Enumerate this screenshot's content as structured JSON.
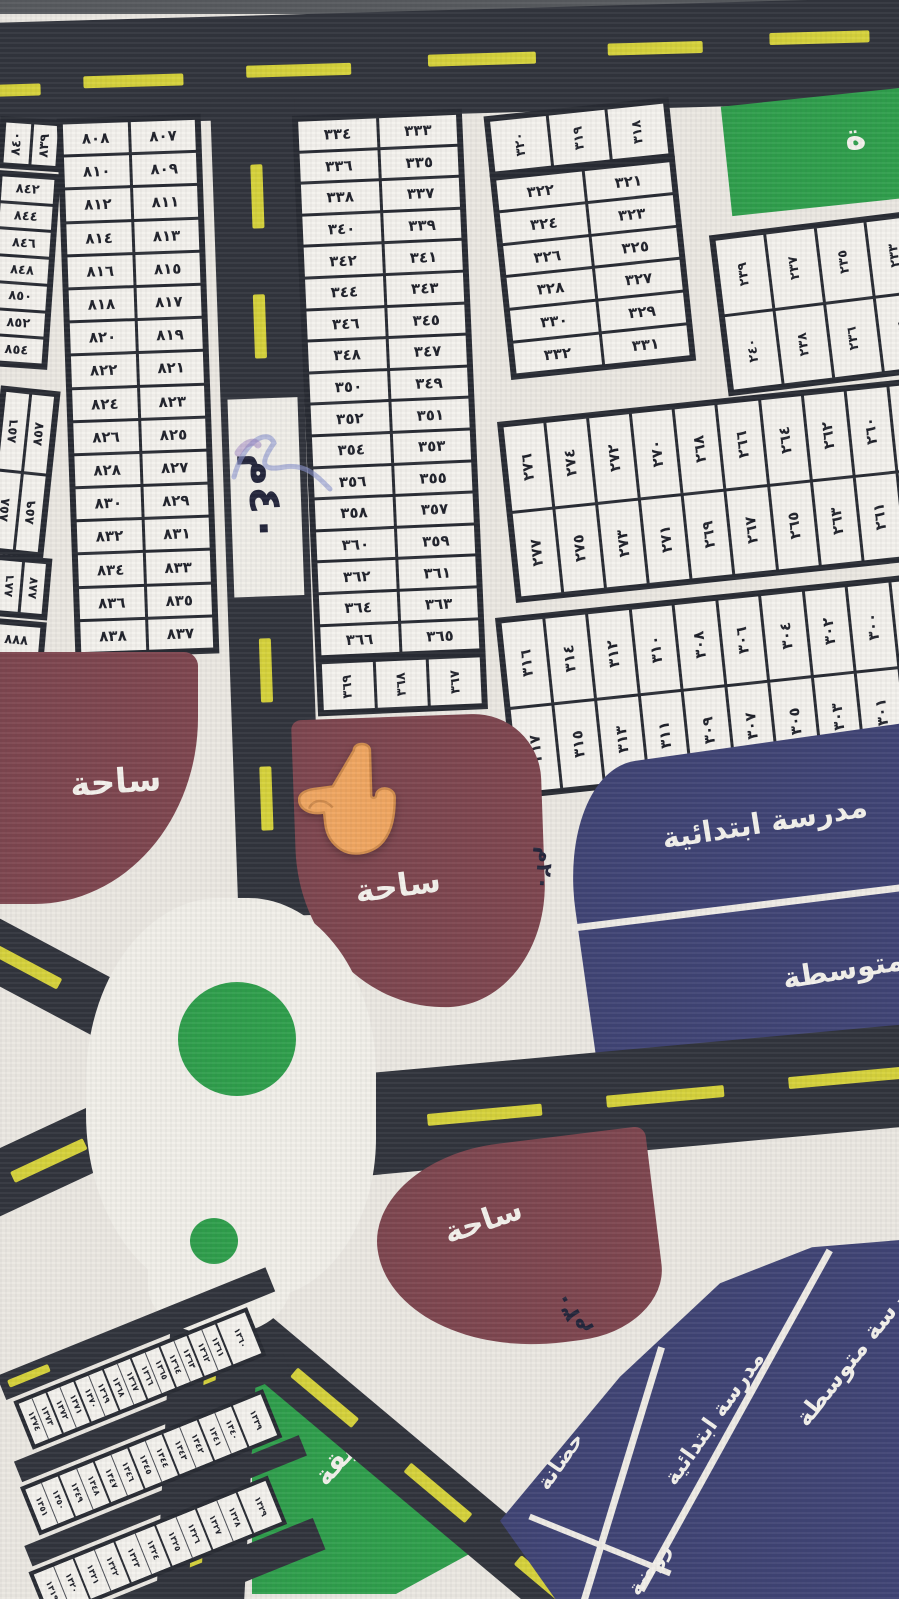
{
  "labels": {
    "plaza": "ساحة",
    "garden": "حديقة",
    "garden_partial": "ة",
    "elementary_school": "مدرسة ابتدائية",
    "middle_school_partial": "ة متوسطة",
    "middle_school": "مدرسة متوسطة",
    "nursery": "حضانة",
    "kindergarten": "روضة",
    "street_sign": "٤٠م",
    "width_marker_20": "٢٠م",
    "width_marker_30": "٣٠م"
  },
  "icons": {
    "pointer": "pointing-up-finger",
    "scribble": "pen-scribble"
  },
  "colors": {
    "road": "#30333b",
    "dash": "#d6d23a",
    "maroon": "#7d454e",
    "navy": "#3f4374",
    "green": "#2e9e4b",
    "paper": "#ebe8e2",
    "cell": "#f4f2ed",
    "ink": "#1e2029"
  },
  "blocks": {
    "west_header": [
      "٨٤٠",
      "٨٣٩"
    ],
    "west_col": [
      "٨٤٢",
      "٨٤٤",
      "٨٤٦",
      "٨٤٨",
      "٨٥٠",
      "٨٥٢",
      "٨٥٤"
    ],
    "west_rows": [
      [
        "٨٠٨",
        "٨٠٧"
      ],
      [
        "٨١٠",
        "٨٠٩"
      ],
      [
        "٨١٢",
        "٨١١"
      ],
      [
        "٨١٤",
        "٨١٣"
      ],
      [
        "٨١٦",
        "٨١٥"
      ],
      [
        "٨١٨",
        "٨١٧"
      ],
      [
        "٨٢٠",
        "٨١٩"
      ],
      [
        "٨٢٢",
        "٨٢١"
      ],
      [
        "٨٢٤",
        "٨٢٣"
      ],
      [
        "٨٢٦",
        "٨٢٥"
      ],
      [
        "٨٢٨",
        "٨٢٧"
      ],
      [
        "٨٣٠",
        "٨٢٩"
      ],
      [
        "٨٣٢",
        "٨٣١"
      ],
      [
        "٨٣٤",
        "٨٣٣"
      ],
      [
        "٨٣٦",
        "٨٣٥"
      ],
      [
        "٨٣٨",
        "٨٣٧"
      ]
    ],
    "west_quad": [
      "٨٥٦",
      "٨٥٧",
      "٨٥٨",
      "٨٥٩"
    ],
    "west_pair": [
      "٨٨٦",
      "٨٨٧"
    ],
    "west_single": "٨٨٨",
    "center_rows": [
      [
        "٣٣٤",
        "٣٣٣"
      ],
      [
        "٣٣٦",
        "٣٣٥"
      ],
      [
        "٣٣٨",
        "٣٣٧"
      ],
      [
        "٣٤٠",
        "٣٣٩"
      ],
      [
        "٣٤٢",
        "٣٤١"
      ],
      [
        "٣٤٤",
        "٣٤٣"
      ],
      [
        "٣٤٦",
        "٣٤٥"
      ],
      [
        "٣٤٨",
        "٣٤٧"
      ],
      [
        "٣٥٠",
        "٣٤٩"
      ],
      [
        "٣٥٢",
        "٣٥١"
      ],
      [
        "٣٥٤",
        "٣٥٣"
      ],
      [
        "٣٥٦",
        "٣٥٥"
      ],
      [
        "٣٥٨",
        "٣٥٧"
      ],
      [
        "٣٦٠",
        "٣٥٩"
      ],
      [
        "٣٦٢",
        "٣٦١"
      ],
      [
        "٣٦٤",
        "٣٦٣"
      ],
      [
        "٣٦٦",
        "٣٦٥"
      ]
    ],
    "center_bottom": [
      "٣٦٩",
      "٣٦٨",
      "٣٦٧"
    ],
    "ne_header": [
      "٣٢٠",
      "٣١٩",
      "٣١٨"
    ],
    "ne_rows": [
      [
        "٣٢٢",
        "٣٢١"
      ],
      [
        "٣٢٤",
        "٣٢٣"
      ],
      [
        "٣٢٦",
        "٣٢٥"
      ],
      [
        "٣٢٨",
        "٣٢٧"
      ],
      [
        "٣٣٠",
        "٣٢٩"
      ],
      [
        "٣٣٢",
        "٣٣١"
      ]
    ],
    "far_ne_top": [
      "٢٣٩",
      "٢٣٧",
      "٢٣٥",
      "٢٣٣"
    ],
    "far_ne_bottom": [
      "٢٤٠",
      "٢٣٨",
      "٢٣٦",
      "٢٣٤"
    ],
    "east1_top": [
      "٢٧٦",
      "٢٧٤",
      "٢٧٢",
      "٢٧٠",
      "٢٦٨",
      "٢٦٦",
      "٢٦٤",
      "٢٦٢",
      "٢٦٠",
      "٢٥٨"
    ],
    "east1_bottom": [
      "٢٧٧",
      "٢٧٥",
      "٢٧٣",
      "٢٧١",
      "٢٦٩",
      "٢٦٧",
      "٢٦٥",
      "٢٦٣",
      "٢٦١",
      "٢٥٩"
    ],
    "east2_top": [
      "٣١٦",
      "٣١٤",
      "٣١٢",
      "٣١٠",
      "٣٠٨",
      "٣٠٦",
      "٣٠٤",
      "٣٠٢",
      "٣٠٠",
      "٢٩٨"
    ],
    "east2_bottom": [
      "٣١٧",
      "٣١٥",
      "٣١٣",
      "٣١١",
      "٣٠٩",
      "٣٠٧",
      "٣٠٥",
      "٣٠٣",
      "٣٠١",
      "٢٩٩"
    ],
    "sw1_end": "١٣٦٠",
    "sw1_pairs": [
      [
        "١٣٧٤",
        "١٣٧٣"
      ],
      [
        "١٣٧٢",
        "١٣٧١"
      ],
      [
        "١٣٧٠",
        "١٣٦٩"
      ],
      [
        "١٣٦٨",
        "١٣٦٧"
      ],
      [
        "١٣٦٦",
        "١٣٦٥"
      ],
      [
        "١٣٦٤",
        "١٣٦٣"
      ],
      [
        "١٣٦٢",
        "١٣٦١"
      ]
    ],
    "sw2_end": "١٣٣٩",
    "sw2_pairs": [
      [
        "١٣٥١",
        "١٣٥٠"
      ],
      [
        "١٣٤٩",
        "١٣٤٨"
      ],
      [
        "١٣٤٧",
        "١٣٤٦"
      ],
      [
        "١٣٤٥",
        "١٣٤٤"
      ],
      [
        "١٣٤٣",
        "١٣٤٢"
      ],
      [
        "١٣٤١",
        "١٣٤٠"
      ]
    ],
    "sw3_end": "١٣٢٩",
    "sw3_pairs": [
      [
        "١٣١٩",
        "١٣٢٠"
      ],
      [
        "١٣٢١",
        "١٣٢٢"
      ],
      [
        "١٣٢٣",
        "١٣٢٤"
      ],
      [
        "١٣٢٥",
        "١٣٢٦"
      ],
      [
        "١٣٢٧",
        "١٣٢٨"
      ]
    ]
  }
}
